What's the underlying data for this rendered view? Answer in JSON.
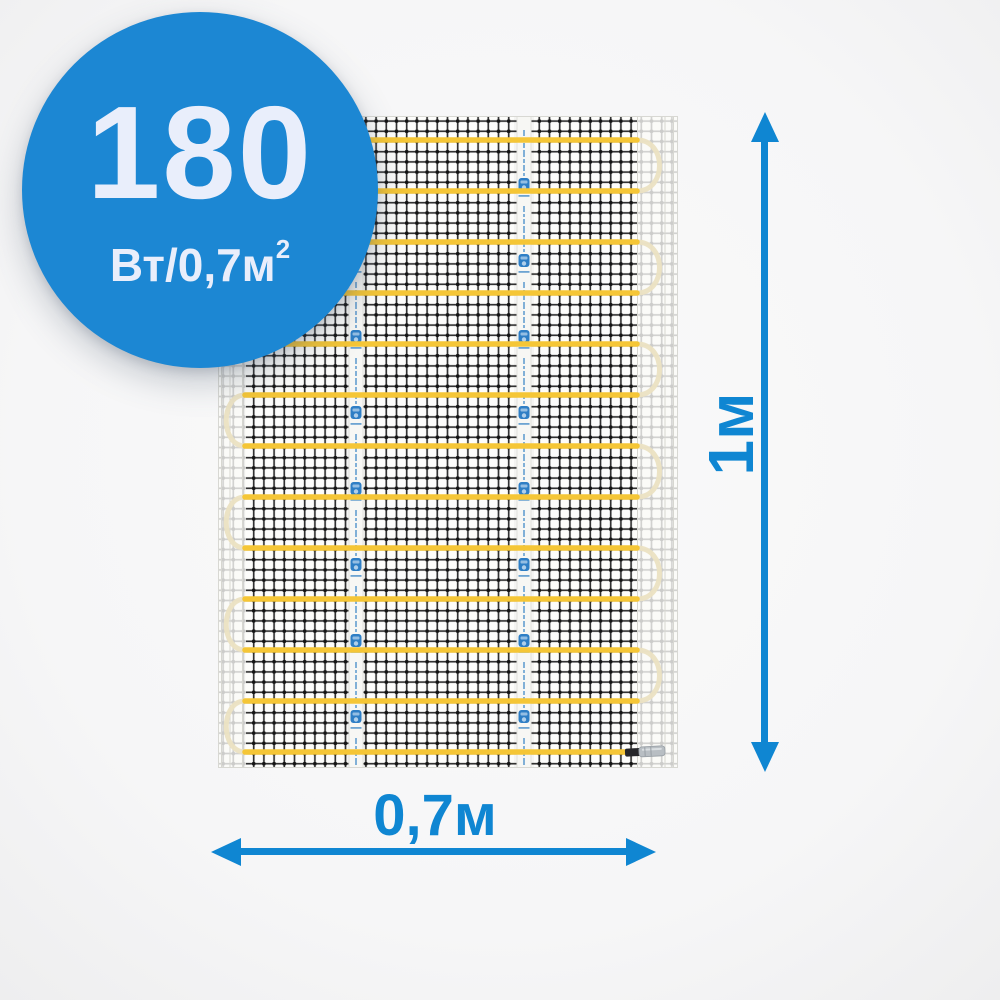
{
  "page": {
    "background": "#f7f7f8"
  },
  "badge": {
    "value": "180",
    "unit": "Вт/0,7м",
    "unit_sup": "2",
    "bg_color": "#1c87d3",
    "text_color": "#e9eefb"
  },
  "dimensions": {
    "height_label": "1м",
    "width_label": "0,7м",
    "color": "#0f86d2"
  },
  "mat": {
    "x": 218,
    "y": 116,
    "width": 460,
    "height": 652,
    "bg_color": "#fdfdfb",
    "border_color": "#d8d8d3",
    "mesh_color": "#202020",
    "mesh_cell": 10.2,
    "mesh_stroke": 1.7,
    "cable_color": "#f5c636",
    "cable_width": 5.5,
    "loop_color": "#ebe1c2",
    "cable_rows": 13,
    "first_row_y": 24,
    "row_spacing": 51,
    "cable_x_start": 27,
    "cable_x_end": 419,
    "left_loop_bulge": 25,
    "right_loop_bulge": 30,
    "band_left_width": 28,
    "band_right_x": 419,
    "band_color": "rgba(250,250,247,0.8)",
    "selvage_line_color": "#d7d7d1",
    "tape_centers_x": [
      138,
      306
    ],
    "tape_width": 14,
    "tape_color": "#f7f7f4",
    "tape_mark_color": "#4a8ec9",
    "tape_logo_color": "#2e7ec5",
    "tape_repeat": 76,
    "connector": {
      "cable_end_x": 407,
      "sleeve_x": 407,
      "sleeve_w": 16,
      "crimp_x": 421,
      "crimp_w": 26,
      "sleeve_color": "#26262a",
      "crimp_color": "#b8bec3",
      "crimp_edge_color": "#989fa5",
      "crimp_shine_color": "#dde1e4"
    }
  }
}
